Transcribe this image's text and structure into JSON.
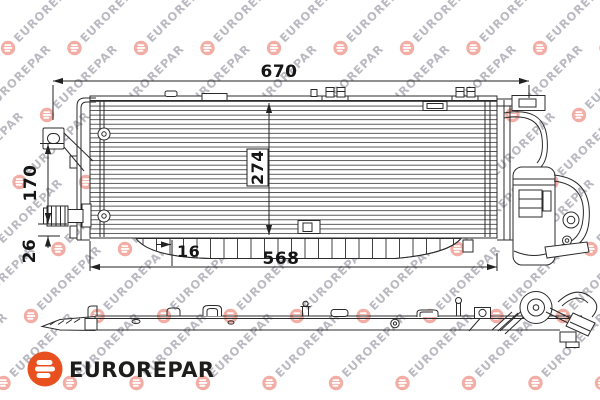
{
  "watermark": {
    "text": "EUROREPAR"
  },
  "logo": {
    "brand": "EUROREPAR",
    "accent_color": "#E8501F",
    "text_color": "#1D1D1B"
  },
  "diagram": {
    "part_type": "condenser-technical-drawing",
    "dimensions": {
      "overall_width": "670",
      "core_height": "274",
      "bracket_height": "170",
      "pipe_offset": "26",
      "inset": "16",
      "mounting_width": "568"
    }
  }
}
